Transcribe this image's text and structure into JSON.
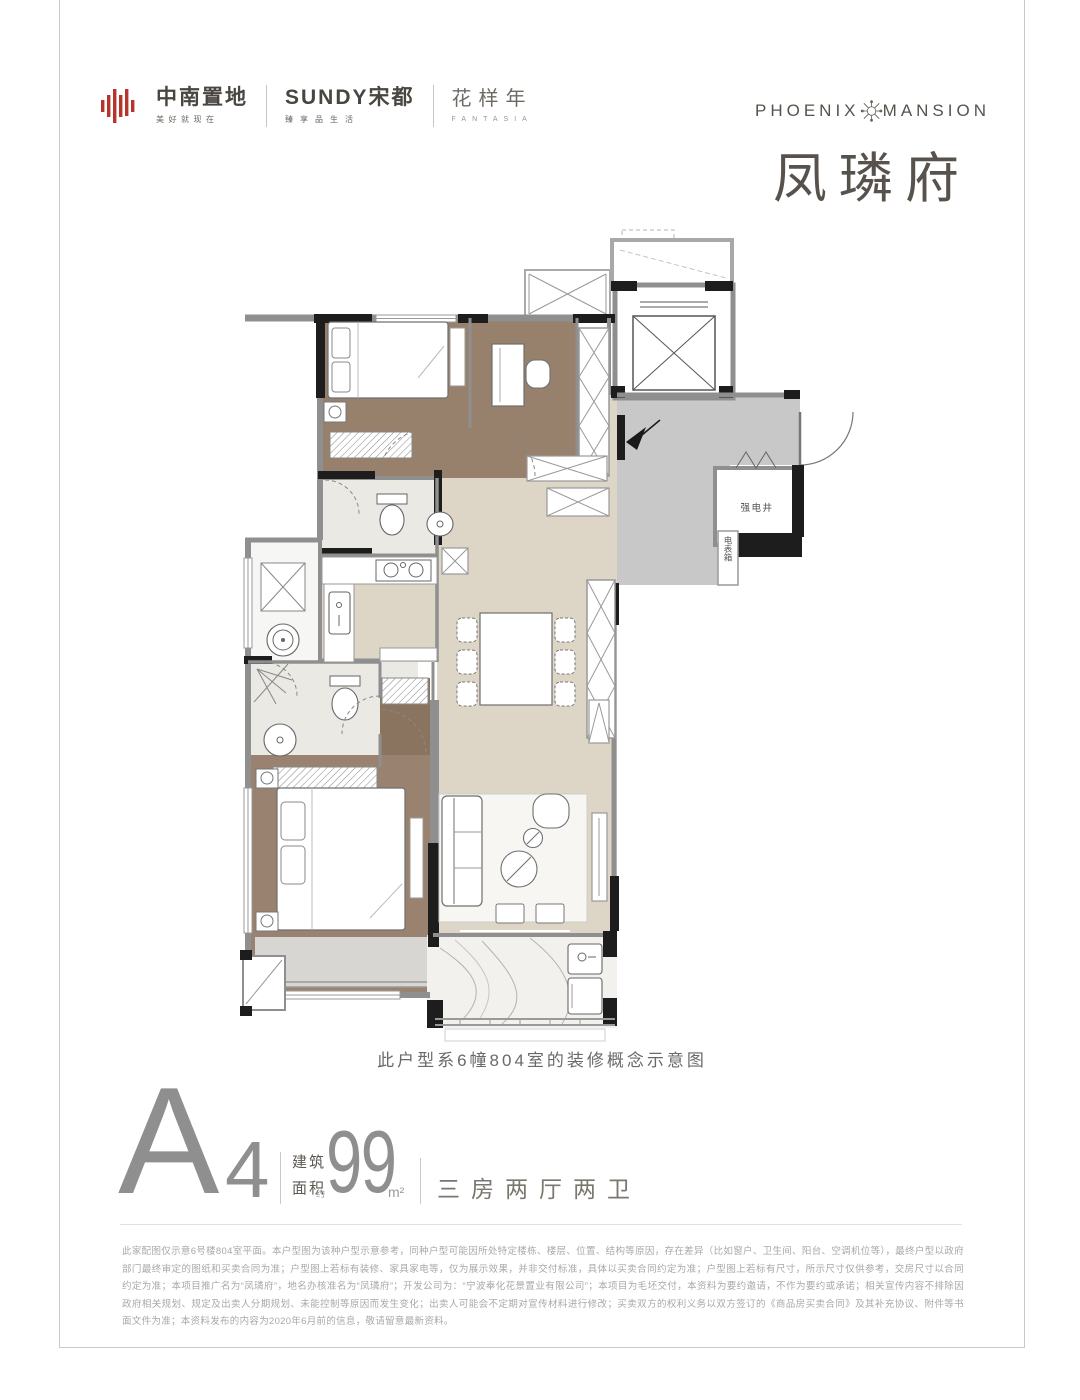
{
  "brand_bar": {
    "zhongnan_name": "中南置地",
    "zhongnan_tagline": "美好就现在",
    "sundy_name": "SUNDY宋都",
    "sundy_tagline": "臻享品生活",
    "fantasia_name": "花样年",
    "fantasia_sub": "FANTASIA"
  },
  "project": {
    "en_left": "PHOENIX",
    "en_right": "MANSION",
    "cn_name": "凤璘府"
  },
  "floorplan": {
    "caption": "此户型系6幢804室的装修概念示意图",
    "label_electric_shaft": "强电井",
    "label_meter_box": "电表箱"
  },
  "unit": {
    "type_letter": "A",
    "type_number": "4",
    "area_label_1": "建筑",
    "area_label_2": "面积",
    "approx": "约",
    "area_value": "99",
    "area_unit": "m²",
    "layout": "三房两厅两卫"
  },
  "disclaimer": "此家配图仅示意6号楼804室平面。本户型图为该种户型示意参考，同种户型可能因所处特定楼栋、楼层、位置、结构等原因，存在差异（比如窗户、卫生间、阳台、空调机位等），最终户型以政府部门最终审定的图纸和买卖合同为准；户型图上若标有装修、家具家电等，仅为展示效果，并非交付标准，具体以买卖合同约定为准；户型图上若标有尺寸，所示尺寸仅供参考，交房尺寸以合同约定为准；本项目推广名为“凤璘府”，地名办核准名为“凤璘府”；开发公司为：“宁波奉化花景置业有限公司”；本项目为毛坯交付，本资料为要约邀请，不作为要约或承诺；相关宣传内容不排除因政府相关规划、规定及出卖人分期规划、未能控制等原因而发生变化；出卖人可能会不定期对宣传材料进行修改；买卖双方的权利义务以双方签订的《商品房买卖合同》及其补充协议、附件等书面文件为准；本资料发布的内容为2020年6月前的信息，敬请留意最新资料。",
  "colors": {
    "brand_red": "#b5342c",
    "title_gray": "#57534c",
    "wall_black": "#1d1d1d",
    "wall_gray": "#8f8f8f",
    "floor_wood": "#99826f",
    "floor_marble": "#ddd5c5",
    "entry_gray": "#c8c8c8",
    "bath_light": "#ebe9e4"
  }
}
